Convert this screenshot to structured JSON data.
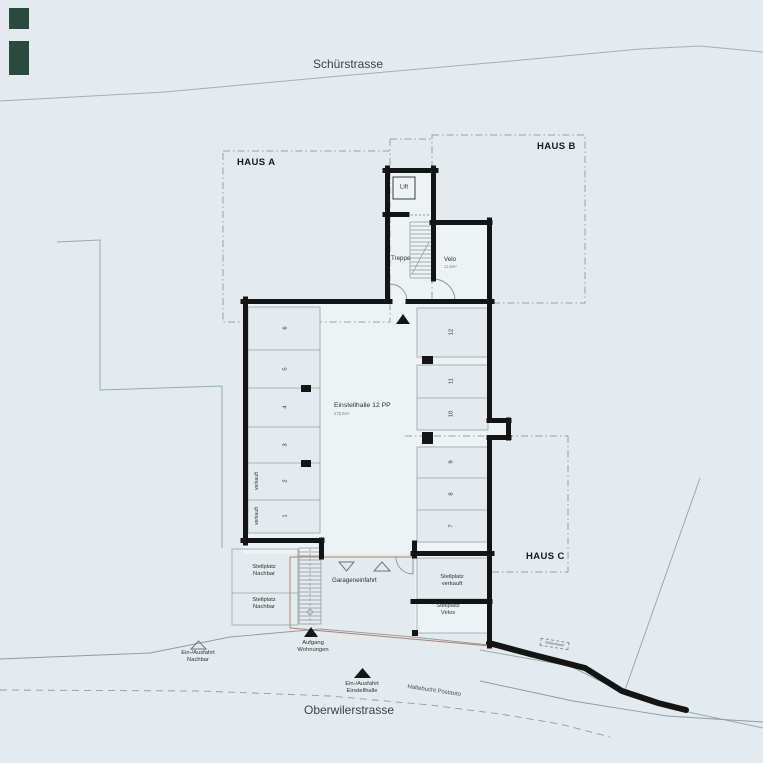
{
  "colors": {
    "background": "#e4eaed",
    "wall": "#141414",
    "terrain_line": "#8fb0ac",
    "road_line": "#939c9f",
    "house_outline": "#98a2a5",
    "boundary_line_red": "#ad8273",
    "marker_green": "#2a4a3e"
  },
  "streets": {
    "top": "Schürstrasse",
    "bottom": "Oberwilerstrasse",
    "bus_stop": "Haltebucht Postauto"
  },
  "houses": {
    "a": "HAUS A",
    "b": "HAUS B",
    "c": "HAUS C"
  },
  "garage": {
    "name": "Einstellhalle 12 PP",
    "area": "279.5m²",
    "entrance_label": "Garageneinfahrt",
    "wall_note": "Stützmauer"
  },
  "rooms": {
    "lift": "Lift",
    "stairs": "Treppe",
    "velo": "Velo",
    "velo_area": "11.5m²"
  },
  "stalls": {
    "left": [
      {
        "number": "6",
        "note": ""
      },
      {
        "number": "5",
        "note": ""
      },
      {
        "number": "4",
        "note": ""
      },
      {
        "number": "3",
        "note": ""
      },
      {
        "number": "2",
        "note": "verkauft"
      },
      {
        "number": "1",
        "note": "verkauft"
      }
    ],
    "right": [
      {
        "number": "12"
      },
      {
        "number": "11"
      },
      {
        "number": "10"
      },
      {
        "number": "9"
      },
      {
        "number": "8"
      },
      {
        "number": "7"
      }
    ]
  },
  "outdoor": {
    "neighbor_stall_upper": {
      "l1": "Stellplatz",
      "l2": "Nachbar"
    },
    "neighbor_stall_lower": {
      "l1": "Stellplatz",
      "l2": "Nachbar"
    },
    "sold_stall": {
      "l1": "Stellplatz",
      "l2": "verkauft"
    },
    "velo_stall": {
      "l1": "Stellplatz",
      "l2": "Velos"
    },
    "stair_up": {
      "l1": "Aufgang",
      "l2": "Wohnungen"
    },
    "entrance_hall": {
      "l1": "Ein-/Ausfahrt",
      "l2": "Einstellhalle"
    },
    "entrance_neighbor": {
      "l1": "Ein-/Ausfahrt",
      "l2": "Nachbar"
    }
  }
}
